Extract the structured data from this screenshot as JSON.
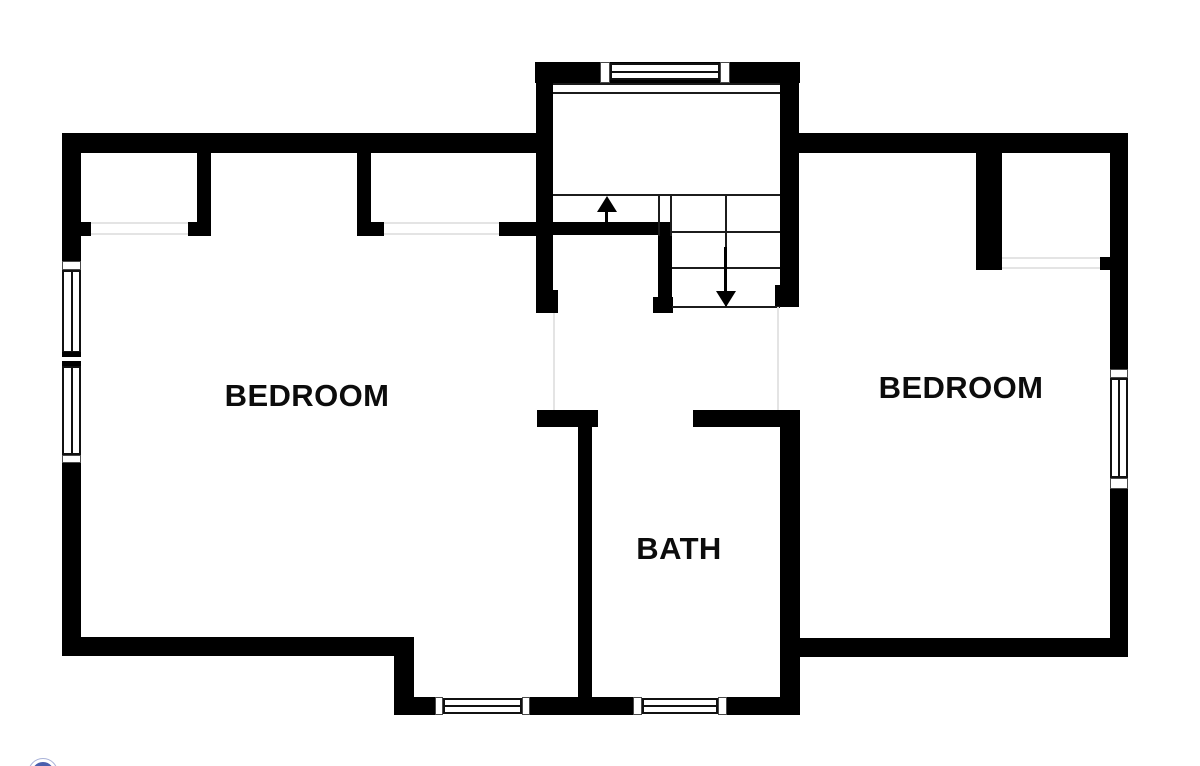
{
  "floorplan": {
    "rooms": [
      {
        "id": "bedroom-left",
        "label": "BEDROOM"
      },
      {
        "id": "bedroom-right",
        "label": "BEDROOM"
      },
      {
        "id": "bath",
        "label": "BATH"
      }
    ],
    "stairs": {
      "up_icon": "arrow-up-icon",
      "down_icon": "arrow-down-icon"
    },
    "colors": {
      "wall": "#000000",
      "background": "#ffffff",
      "stair_line": "#1c1c1c",
      "opening_line": "#e4e4e4",
      "logo_outer_ring": "#a9b2d8",
      "logo_inner_ring": "#4a5fad"
    }
  }
}
